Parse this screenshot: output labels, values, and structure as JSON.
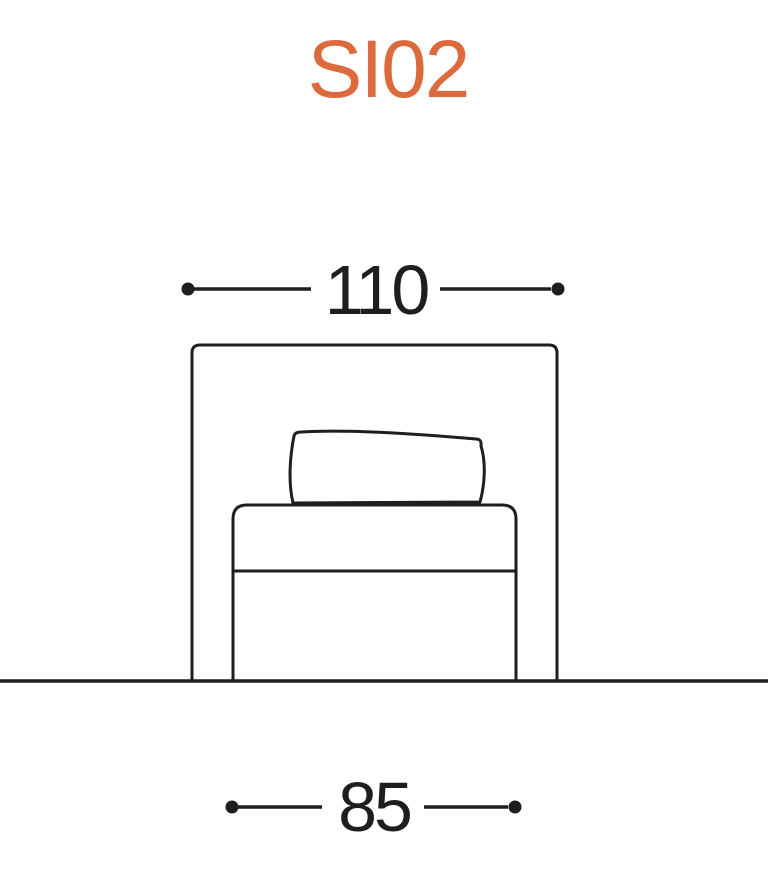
{
  "title": {
    "text": "SI02",
    "color": "#dd6a3d"
  },
  "drawing": {
    "description": "front elevation line drawing of armless sofa module on ground line",
    "line_color": "#1e1e1e",
    "dimensions": {
      "overall_width": "110",
      "seat_width": "85"
    }
  }
}
